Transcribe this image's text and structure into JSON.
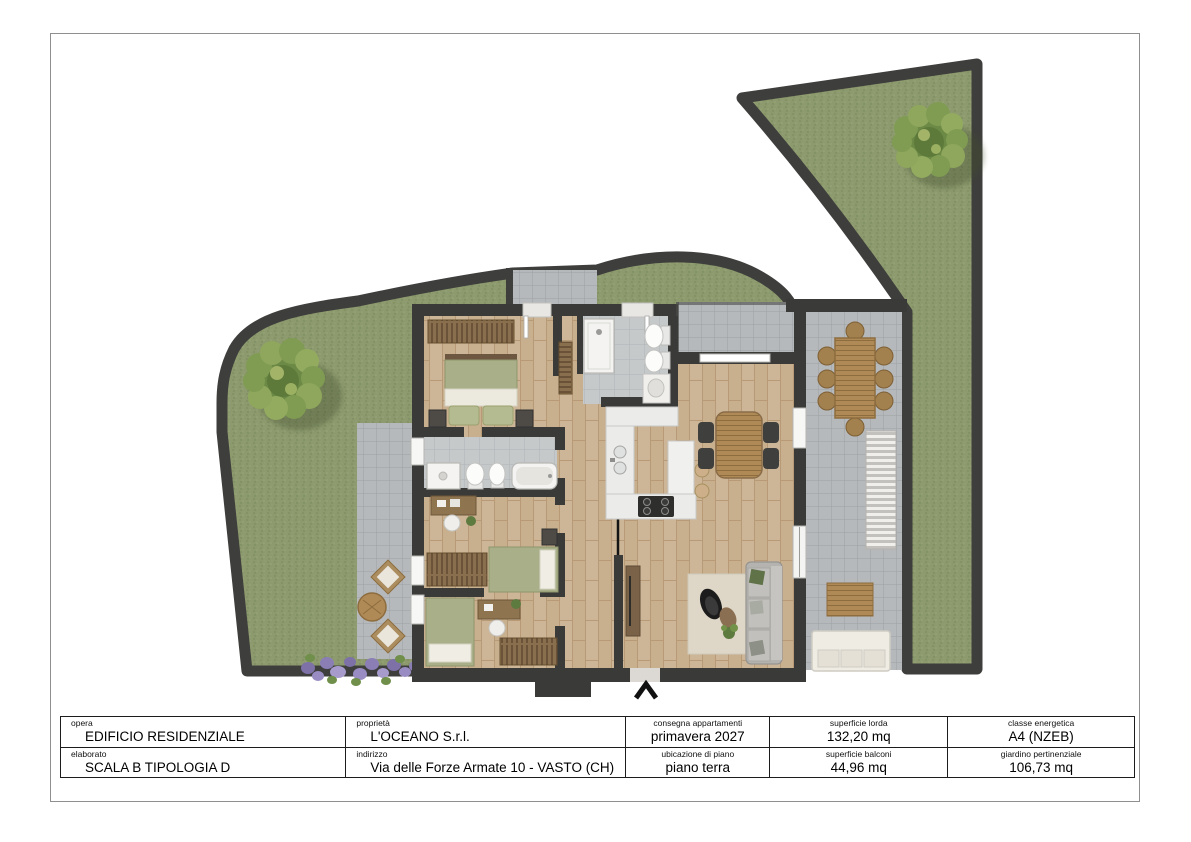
{
  "title_block": {
    "opera": {
      "label": "opera",
      "value": "EDIFICIO RESIDENZIALE"
    },
    "elaborato": {
      "label": "elaborato",
      "value": "SCALA B TIPOLOGIA D"
    },
    "proprieta": {
      "label": "proprietà",
      "value": "L'OCEANO S.r.l."
    },
    "indirizzo": {
      "label": "indirizzo",
      "value": "Via delle Forze Armate 10 - VASTO (CH)"
    },
    "consegna": {
      "label": "consegna appartamenti",
      "value": "primavera 2027"
    },
    "ubicazione": {
      "label": "ubicazione di piano",
      "value": "piano terra"
    },
    "superficie_lorda": {
      "label": "superficie lorda",
      "value": "132,20 mq"
    },
    "superficie_balconi": {
      "label": "superficie balconi",
      "value": "44,96 mq"
    },
    "classe_energetica": {
      "label": "classe energetica",
      "value": "A4 (NZEB)"
    },
    "giardino": {
      "label": "giardino pertinenziale",
      "value": "106,73 mq"
    }
  },
  "colors": {
    "grass": "#8d9a6e",
    "wall": "#3a3a38",
    "wood_floor": "#cdb697",
    "bath_tile": "#c6c9ca",
    "terrace_tile": "#b6b9bb",
    "furniture_wood": "#b08a56",
    "bed_linen_olive": "#a9b089",
    "tree_green": "#6c8a46",
    "lavender": "#8a7eb5",
    "page_frame": "#8f8f8f"
  }
}
